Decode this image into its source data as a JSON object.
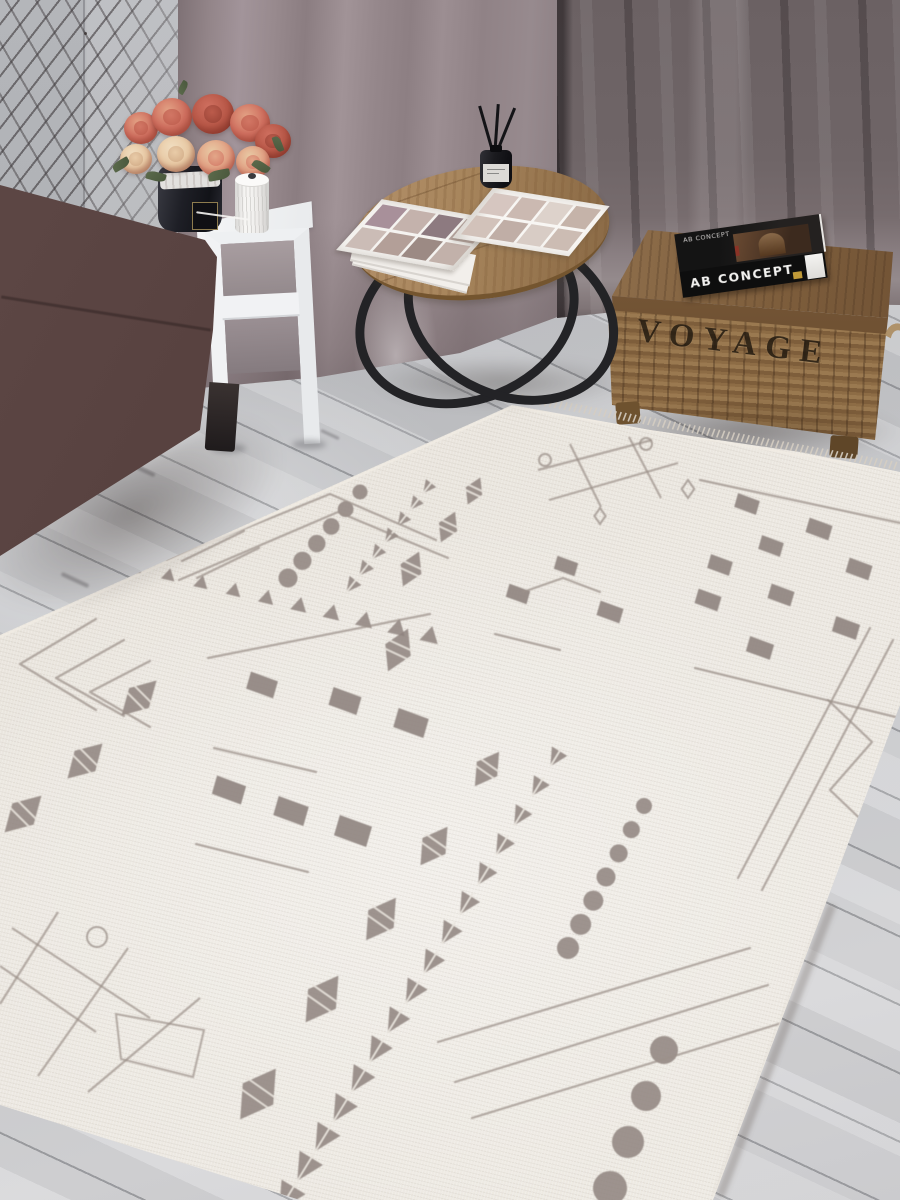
{
  "texts": {
    "trunk": "VOYAGE",
    "book_side": "AB CONCEPT",
    "book_cover": "AB CONCEPT"
  },
  "palette": {
    "wall": "#b4b6ba",
    "grid_wire": "rgba(42,36,38,.65)",
    "curtain_left": "#a2949a",
    "curtain_right": "#6b6163",
    "floor": "#c6c7ca",
    "floor_dark": "#b9babe",
    "sofa": "#57413f",
    "sofa_dark": "#352928",
    "sofa_leg": "#1f1b1c",
    "table_white": "#f1f2f4",
    "vase": "#1e1f26",
    "flower_coral": "#cf6f5f",
    "flower_coral_dark": "#b85848",
    "flower_peach": "#e2a184",
    "flower_cream": "#e8c9a4",
    "leaf_green": "#5c6b4c",
    "spool_white": "#f4f3f1",
    "wood_top": "#a8865d",
    "wood_rim": "#74552f",
    "metal": "#232326",
    "lid_wood": "#7e5e3c",
    "wicker": "#8d6c45",
    "wicker_dark": "#7e5e3b",
    "trunk_text": "#20180f",
    "book_black": "#141414",
    "book_text": "#f2f1ef",
    "gold": "#c09a38",
    "rug_base": "#ece8e1",
    "page_white": "#f5f3f0"
  },
  "magazine": {
    "left_swatches": [
      "#a8909a",
      "#c4b2ac",
      "#8d7a80",
      "#b9a7a1",
      "#cbbcb6",
      "#b39f98",
      "#9c8a84",
      "#c2b1aa"
    ],
    "right_swatches": [
      "#d6c6c0",
      "#cbb9b1",
      "#ddd2cb",
      "#c5b3a9",
      "#d2c2ba",
      "#c0aea6",
      "#d8ccc5",
      "#ccbcb3"
    ]
  },
  "rug_pattern": {
    "motif_color": "#8e837e",
    "line_color": "#9b9089",
    "stripe_color": "#e9e4dd",
    "fringe_color": "#d5cec2",
    "edge_color": "#f1ece4",
    "groups": [
      {
        "t": "dots",
        "p1": [
          349,
          398
        ],
        "p2": [
          278,
          464
        ],
        "n": 6,
        "r1": 6.5,
        "r2": 8.5
      },
      {
        "t": "dots",
        "p1": [
          360,
          492
        ],
        "p2": [
          288,
          578
        ],
        "n": 6,
        "r1": 7.5,
        "r2": 9.5
      },
      {
        "t": "dots",
        "p1": [
          644,
          806
        ],
        "p2": [
          568,
          948
        ],
        "n": 7,
        "r1": 8,
        "r2": 11
      },
      {
        "t": "dots",
        "p1": [
          664,
          1050
        ],
        "p2": [
          610,
          1188
        ],
        "n": 4,
        "r1": 14,
        "r2": 17
      },
      {
        "t": "tri",
        "p1": [
          136,
          568
        ],
        "p2": [
          430,
          636
        ],
        "n": 10,
        "s1": 12,
        "s2": 17
      },
      {
        "t": "leaves",
        "p1": [
          428,
          487
        ],
        "p2": [
          352,
          585
        ],
        "n": 7,
        "s1": 13,
        "s2": 15
      },
      {
        "t": "leaves",
        "p1": [
          556,
          757
        ],
        "p2": [
          288,
          1196
        ],
        "n": 16,
        "s1": 18,
        "s2": 28
      },
      {
        "t": "sdia",
        "ang": 115,
        "items": [
          [
            474,
            491,
            24,
            18
          ],
          [
            448,
            527,
            27,
            20
          ],
          [
            411,
            569,
            31,
            23
          ],
          [
            398,
            650,
            38,
            28
          ]
        ]
      },
      {
        "t": "sdia",
        "ang": 125,
        "items": [
          [
            487,
            769,
            34,
            25
          ],
          [
            434,
            846,
            38,
            28
          ],
          [
            381,
            919,
            42,
            31
          ],
          [
            322,
            999,
            46,
            34
          ],
          [
            258,
            1094,
            50,
            37
          ]
        ]
      },
      {
        "t": "sdia",
        "ang": 135,
        "items": [
          [
            139,
            698,
            40,
            28
          ],
          [
            85,
            761,
            40,
            29
          ],
          [
            23,
            814,
            42,
            30
          ]
        ]
      },
      {
        "t": "sq",
        "items": [
          [
            566,
            566,
            20
          ],
          [
            610,
            612,
            22
          ],
          [
            518,
            594,
            20
          ]
        ]
      },
      {
        "t": "sq",
        "items": [
          [
            262,
            685,
            26
          ],
          [
            345,
            701,
            27
          ],
          [
            411,
            723,
            29
          ]
        ]
      },
      {
        "t": "sq",
        "items": [
          [
            229,
            790,
            28
          ],
          [
            291,
            811,
            29
          ],
          [
            353,
            831,
            31
          ]
        ]
      },
      {
        "t": "sq",
        "items": [
          [
            747,
            504,
            21
          ],
          [
            819,
            529,
            22
          ],
          [
            771,
            546,
            21
          ],
          [
            720,
            565,
            21
          ],
          [
            859,
            569,
            22
          ],
          [
            708,
            600,
            22
          ],
          [
            781,
            595,
            22
          ],
          [
            846,
            628,
            23
          ],
          [
            760,
            648,
            23
          ]
        ]
      },
      {
        "t": "pl",
        "pts": [
          [
            208,
            658
          ],
          [
            430,
            614
          ]
        ]
      },
      {
        "t": "pl",
        "pts": [
          [
            214,
            748
          ],
          [
            316,
            772
          ]
        ]
      },
      {
        "t": "pl",
        "pts": [
          [
            196,
            844
          ],
          [
            308,
            872
          ]
        ]
      },
      {
        "t": "pl",
        "pts": [
          [
            700,
            480
          ],
          [
            905,
            524
          ]
        ]
      },
      {
        "t": "pl",
        "pts": [
          [
            695,
            668
          ],
          [
            900,
            718
          ]
        ]
      },
      {
        "t": "pl",
        "pts": [
          [
            523,
            592
          ],
          [
            563,
            578
          ],
          [
            600,
            592
          ]
        ]
      },
      {
        "t": "pl",
        "pts": [
          [
            495,
            634
          ],
          [
            560,
            650
          ]
        ]
      },
      {
        "t": "hash",
        "lines": [
          [
            [
              538,
              470
            ],
            [
              652,
              440
            ]
          ],
          [
            [
              549,
              500
            ],
            [
              678,
              463
            ]
          ],
          [
            [
              570,
              444
            ],
            [
              601,
              507
            ]
          ],
          [
            [
              629,
              437
            ],
            [
              661,
              498
            ]
          ]
        ],
        "rings": [
          [
            646,
            444,
            6
          ],
          [
            545,
            460,
            6
          ]
        ],
        "dias": [
          [
            688,
            489,
            9
          ],
          [
            600,
            516,
            8
          ]
        ]
      },
      {
        "t": "hash",
        "lines": [
          [
            [
              12,
              928
            ],
            [
              150,
              1018
            ]
          ],
          [
            [
              58,
              912
            ],
            [
              0,
              1004
            ]
          ],
          [
            [
              128,
              948
            ],
            [
              38,
              1076
            ]
          ],
          [
            [
              200,
              998
            ],
            [
              88,
              1092
            ]
          ],
          [
            [
              0,
              966
            ],
            [
              96,
              1032
            ]
          ]
        ],
        "rings": [
          [
            97,
            937,
            10
          ]
        ],
        "dias": [],
        "poly": [
          [
            116,
            1014
          ],
          [
            204,
            1030
          ],
          [
            193,
            1077
          ],
          [
            121,
            1059
          ]
        ]
      },
      {
        "t": "pl",
        "pts": [
          [
            96,
            619
          ],
          [
            20,
            664
          ],
          [
            96,
            710
          ]
        ]
      },
      {
        "t": "pl",
        "pts": [
          [
            124,
            640
          ],
          [
            56,
            678
          ],
          [
            124,
            716
          ]
        ]
      },
      {
        "t": "pl",
        "pts": [
          [
            150,
            661
          ],
          [
            90,
            692
          ],
          [
            150,
            727
          ]
        ]
      },
      {
        "t": "pl",
        "pts": [
          [
            168,
            543
          ],
          [
            230,
            514
          ]
        ]
      },
      {
        "t": "pl",
        "pts": [
          [
            182,
            561
          ],
          [
            244,
            531
          ]
        ]
      },
      {
        "t": "pl",
        "pts": [
          [
            197,
            578
          ],
          [
            259,
            548
          ]
        ]
      },
      {
        "t": "pl",
        "pts": [
          [
            167,
            560
          ],
          [
            330,
            494
          ],
          [
            436,
            540
          ]
        ]
      },
      {
        "t": "pl",
        "pts": [
          [
            179,
            580
          ],
          [
            338,
            512
          ],
          [
            448,
            558
          ]
        ]
      },
      {
        "t": "pl",
        "pts": [
          [
            438,
            1042
          ],
          [
            750,
            948
          ]
        ]
      },
      {
        "t": "pl",
        "pts": [
          [
            455,
            1082
          ],
          [
            768,
            985
          ]
        ]
      },
      {
        "t": "pl",
        "pts": [
          [
            472,
            1118
          ],
          [
            785,
            1022
          ]
        ]
      },
      {
        "t": "pl",
        "pts": [
          [
            893,
            640
          ],
          [
            762,
            890
          ]
        ]
      },
      {
        "t": "pl",
        "pts": [
          [
            870,
            628
          ],
          [
            738,
            878
          ]
        ]
      },
      {
        "t": "pl",
        "pts": [
          [
            828,
            700
          ],
          [
            872,
            742
          ],
          [
            830,
            790
          ],
          [
            874,
            832
          ]
        ]
      },
      {
        "t": "edge",
        "pts": [
          [
            0,
            637
          ],
          [
            512,
            407
          ],
          [
            897,
            471
          ]
        ]
      },
      {
        "t": "edge",
        "pts": [
          [
            827,
            902
          ],
          [
            714,
            1198
          ]
        ]
      },
      {
        "t": "fringe",
        "p1": [
          515,
          401
        ],
        "p2": [
          897,
          470
        ],
        "step": 5,
        "len": 8
      }
    ]
  }
}
